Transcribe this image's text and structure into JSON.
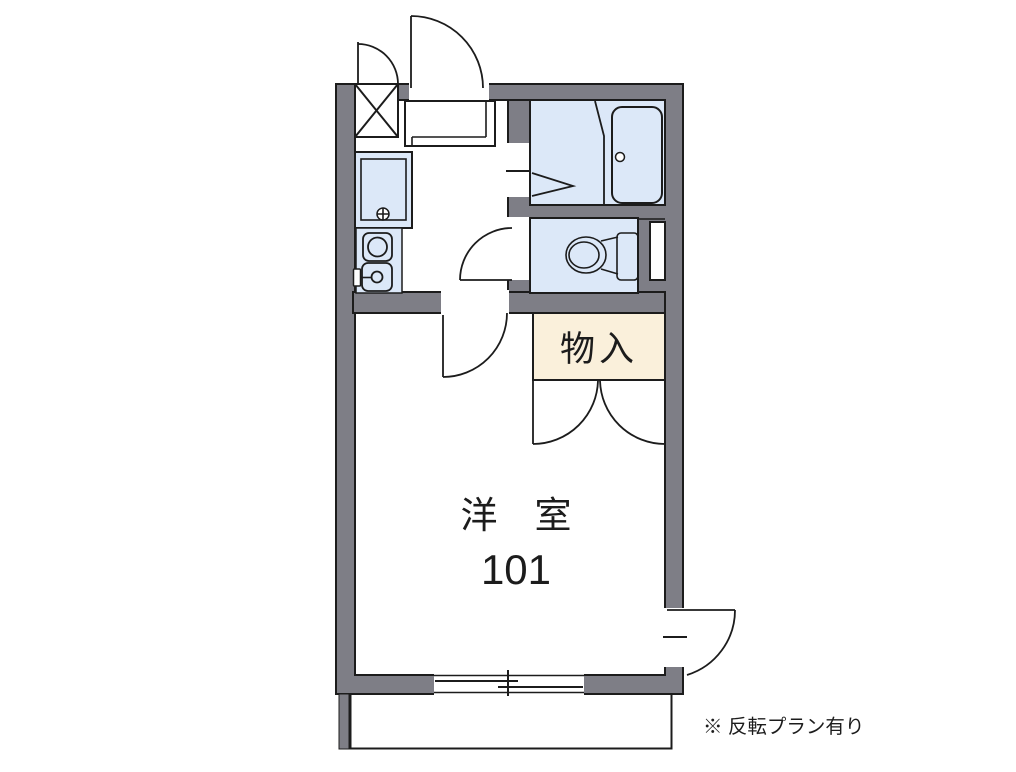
{
  "colors": {
    "wall": "#7e7e86",
    "fixture": "#dce8f8",
    "closet": "#faf0db",
    "line": "#1c1c1c",
    "paper": "#ffffff"
  },
  "labels": {
    "closet": "物入",
    "main_room_name": "洋　室",
    "main_room_number": "101",
    "note": "※ 反転プラン有り"
  }
}
